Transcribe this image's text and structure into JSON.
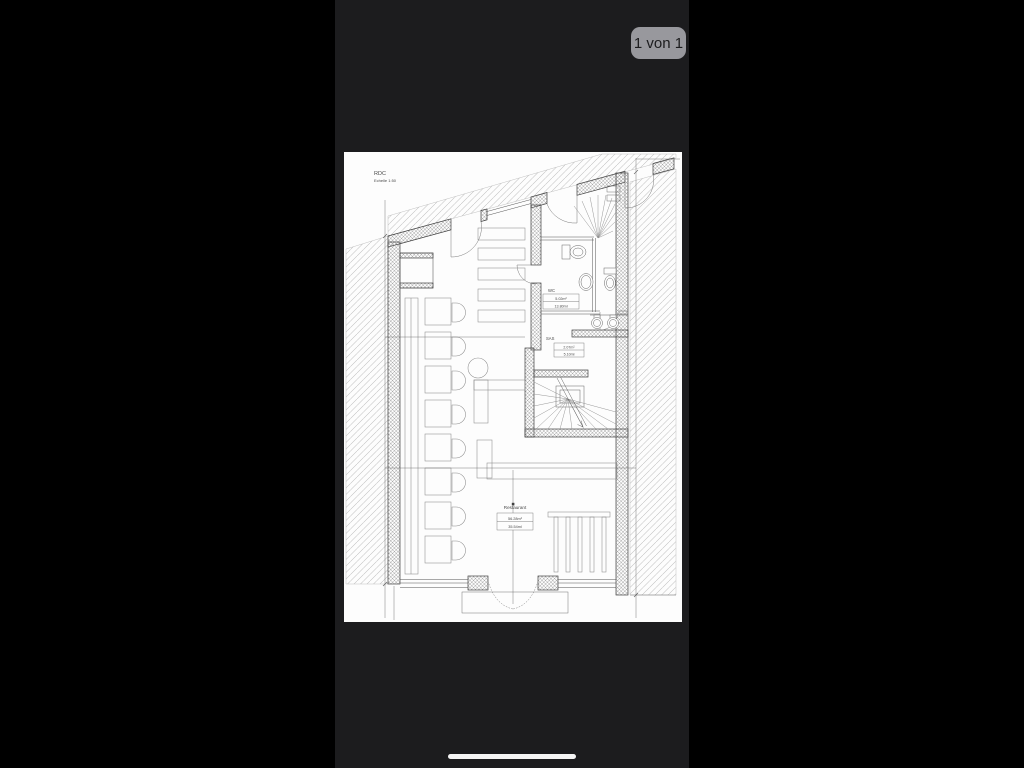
{
  "viewer": {
    "page_indicator": "1 von 1"
  },
  "plan": {
    "title": "RDC",
    "scale": "Echelle 1:50",
    "rooms": [
      {
        "label": "WC",
        "area": "5.02m²",
        "perimeter": "13.80ml"
      },
      {
        "label": "SAS",
        "area": "2.07m²",
        "perimeter": "5.10ml"
      },
      {
        "label": "Restaurant",
        "area": "56.28m²",
        "perimeter": "35.54ml"
      }
    ]
  },
  "colors": {
    "pillarbox": "#000000",
    "viewer_background": "#1c1c1e",
    "badge_background": "#98989d",
    "badge_text": "#1c1c1e",
    "page_background": "#fdfdfd",
    "drawing_ink": "#3f3f3f"
  }
}
